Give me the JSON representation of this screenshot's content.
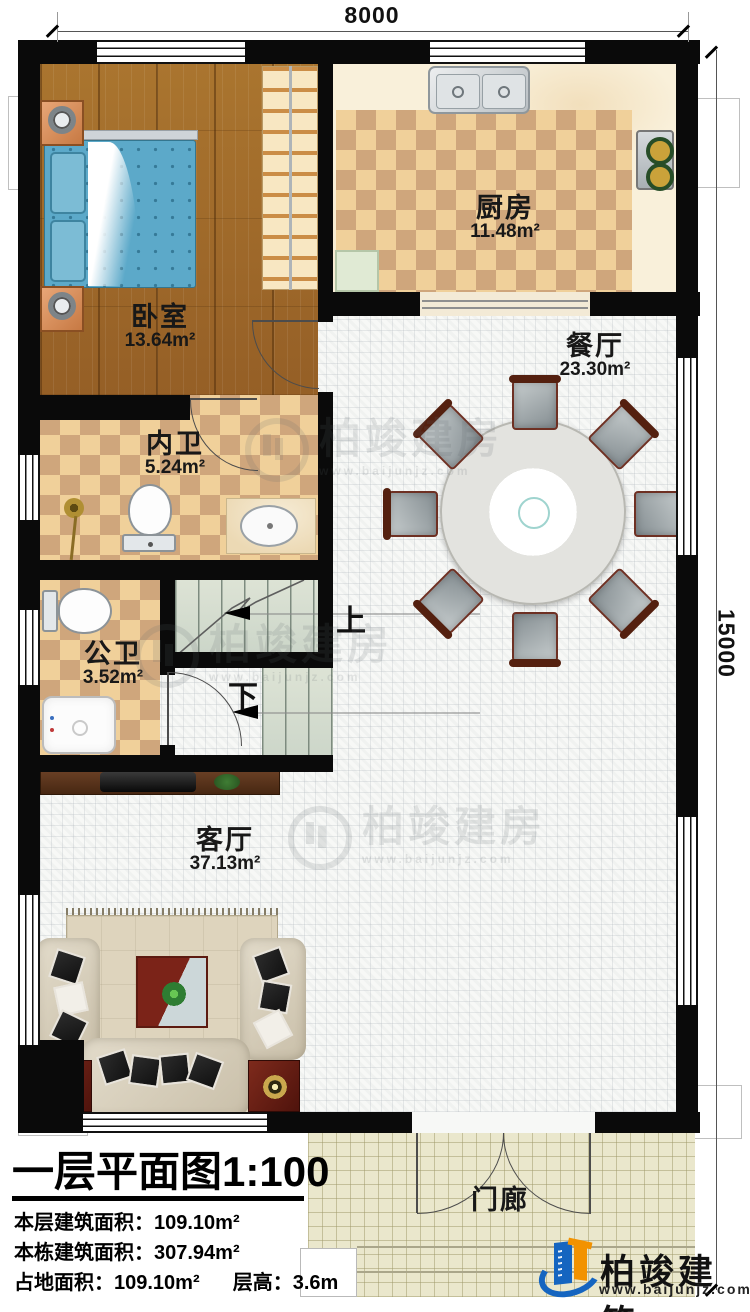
{
  "plan": {
    "title": "一层平面图",
    "scale": "1:100",
    "dimensions": {
      "width": "8000",
      "height": "15000"
    },
    "rooms": {
      "bedroom": {
        "name": "卧室",
        "area": "13.64m²"
      },
      "kitchen": {
        "name": "厨房",
        "area": "11.48m²"
      },
      "dining": {
        "name": "餐厅",
        "area": "23.30m²"
      },
      "inner_bath": {
        "name": "内卫",
        "area": "5.24m²"
      },
      "public_bath": {
        "name": "公卫",
        "area": "3.52m²"
      },
      "living": {
        "name": "客厅",
        "area": "37.13m²"
      },
      "porch": {
        "name": "门廊"
      }
    },
    "stairs": {
      "up": "上",
      "down": "下"
    },
    "stats": [
      {
        "label": "本层建筑面积：",
        "value": "109.10m²"
      },
      {
        "label": "本栋建筑面积：",
        "value": "307.94m²"
      },
      {
        "label": "占地面积：",
        "value": "109.10m²"
      },
      {
        "label": "层高：",
        "value": "3.6m"
      }
    ]
  },
  "brand": {
    "name": "柏竣建筑",
    "url": "www.baijunjz.com"
  },
  "watermark": {
    "name": "柏竣建房",
    "url": "www.baijunjz.com"
  },
  "colors": {
    "accent_blue": "#1565c0",
    "accent_orange": "#f29200",
    "wall": "#0a0a0a"
  }
}
